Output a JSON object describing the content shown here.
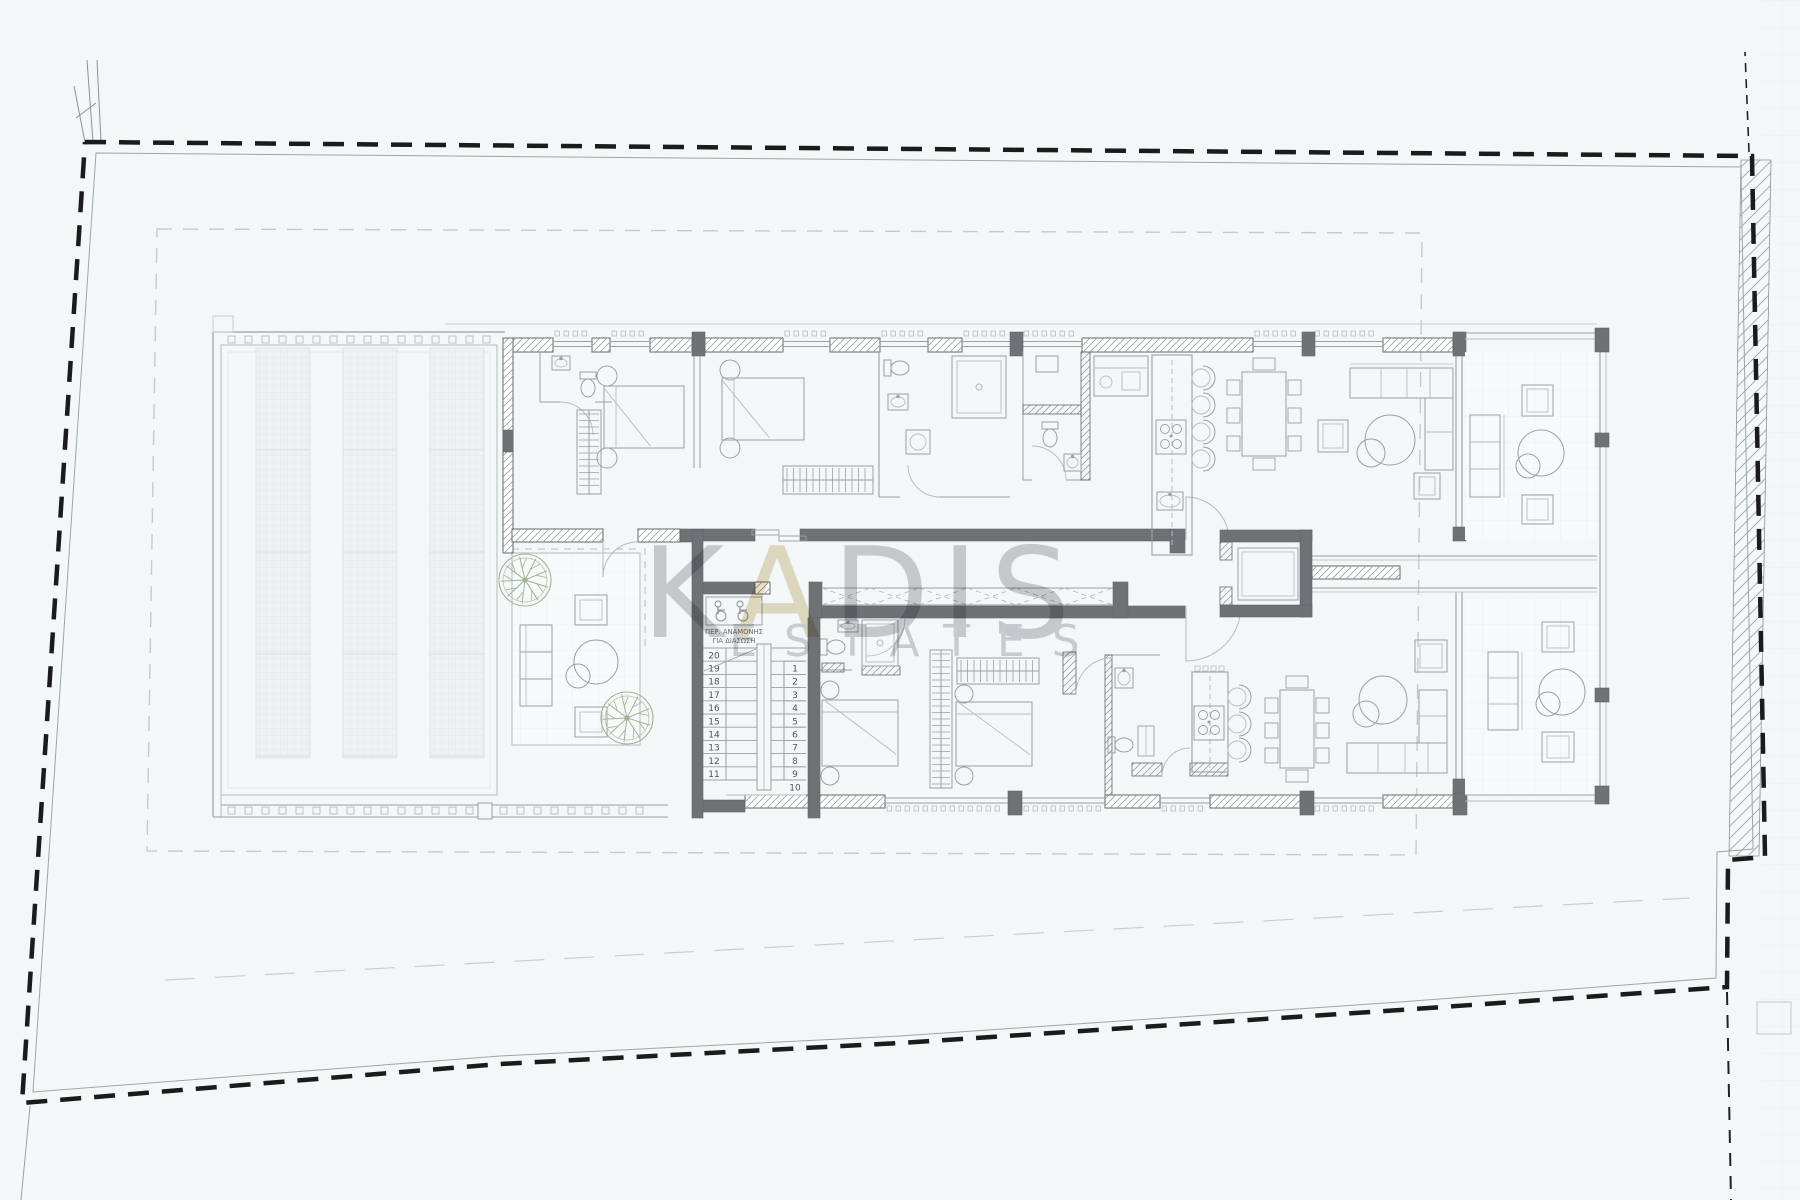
{
  "page": {
    "type": "architectural floor plan",
    "background": "#f3f7f8"
  },
  "watermark": {
    "part1": "K",
    "gold_letter": "A",
    "part2": "DIS",
    "line2": "ESTATES",
    "gray": "#9ea2a5",
    "gold": "#d3bd90"
  },
  "stairwell": {
    "rescue_label_line1": "ΠΕΡ. ΑΝΑΜΟΝΗΣ",
    "rescue_label_line2": "ΓΙΑ ΔΙΑΣΩΣΗ",
    "flight_up_numbers": [
      "20",
      "19",
      "18",
      "17",
      "16",
      "15",
      "14",
      "13",
      "12",
      "11"
    ],
    "flight_down_numbers": [
      "1",
      "2",
      "3",
      "4",
      "5",
      "6",
      "7",
      "8",
      "9",
      "10"
    ]
  },
  "colors": {
    "background": "#f3f7f8",
    "boundary": "#1b1b1b",
    "wall_dark": "#6e7274",
    "wall_edge": "#62676a",
    "line": "#9aa0a3",
    "line_soft": "#b6bbbd",
    "line_light": "#c9ced0",
    "hatch": "#8f9597",
    "planter_fill": "#eef1f2",
    "planter_line": "#e1e5e6",
    "balcony_fill": "#f7fafb",
    "grid_line": "#e7edef",
    "tree": "#a3b293",
    "text_dark": "#4e5456"
  }
}
